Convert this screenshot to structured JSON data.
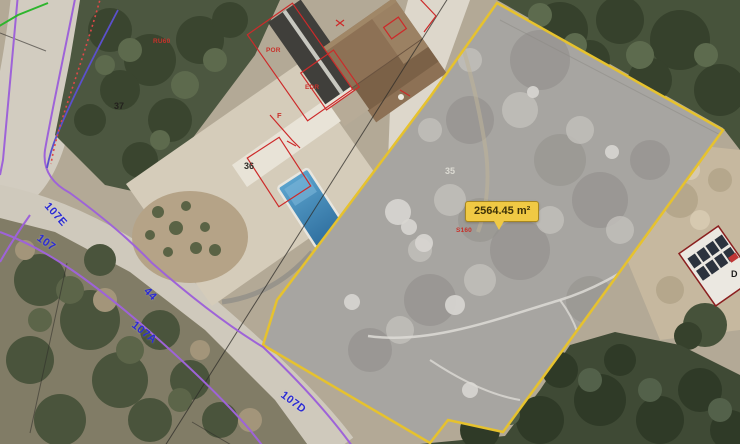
{
  "map": {
    "area_callout": {
      "value": "2564.45 m²"
    },
    "road_labels": {
      "e107": "107E",
      "n107": "107",
      "n44": "44",
      "a107": "107A",
      "d107": "107D"
    },
    "plot_numbers": {
      "p35": "35",
      "p36": "36",
      "p37": "37"
    },
    "red_marks": {
      "r1": "RU60",
      "r2": "S160",
      "por": "POR",
      "edr": "EDR",
      "f": "F"
    },
    "other_labels": {
      "d": "D"
    },
    "colors": {
      "parcel_fill": "#a7a5a1",
      "parcel_border": "#e6c22e",
      "callout_bg": "#f0c944",
      "callout_border": "#a8871f",
      "callout_text": "#3e3208",
      "cadastral_purple": "#9e63d8",
      "cadastral_blue": "#5b50cc",
      "boundary_green": "#2db52d",
      "overlay_red": "#cd2a2a",
      "road_label_blue": "#2b2bd4",
      "pool_blue": "#3c86b8"
    }
  }
}
